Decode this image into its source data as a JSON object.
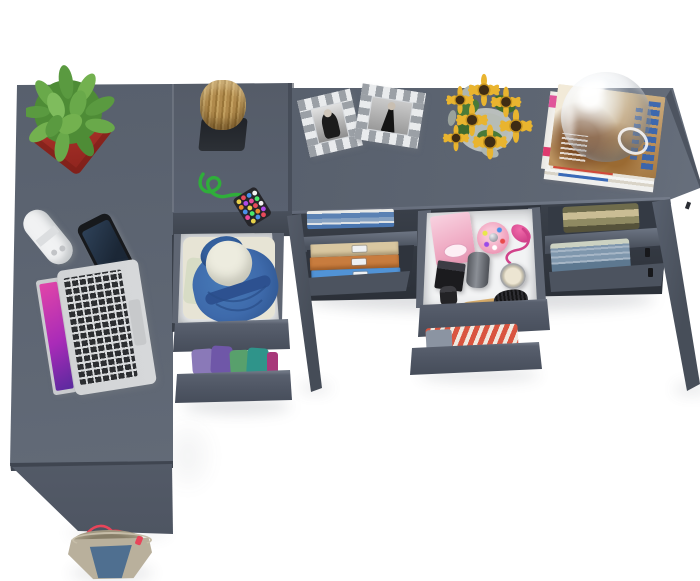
{
  "image_type": "product-photography",
  "subject": "Top-down view of a graphite grey L-shaped corner desk with open drawers and shelves styled with household props",
  "visible_text": [],
  "furniture": {
    "left_wing": "desk top with front panel leg",
    "corner_unit": "square top with two pulled-out drawers",
    "right_wing": "desk top with one open shelf bay, one pulled-out drawer, one shelf bay, two tapered legs"
  },
  "inventory": [
    "cactus in red pot",
    "white charger",
    "smartphone",
    "open laptop",
    "wood stump",
    "black desk pad",
    "green cord keychain with beaded tag",
    "drawer with blue backpack and white shirt",
    "drawer with folded purple, green and teal clothes",
    "shelf with folded blue clothes",
    "stack of beige, orange and blue storage boxes",
    "cosmetics drawer with pink gift box, candy perfume, pink atomizer, black bottles, cream jar and wooden hairbrush",
    "drawer with red striped clothes",
    "shelf with khaki clothes",
    "shelf with folded jeans",
    "two silver checkered picture frames with black and white photos",
    "sunflower bouquet in glass vase",
    "magazine stack",
    "glass dome ball",
    "denim tote bag with red handles"
  ],
  "palette": {
    "bg": "#ffffff",
    "desk_top": "#5a626f",
    "panel": "#535a67",
    "drawer_front": "#4f5664",
    "drawer_bevel": "#6e7683",
    "drawer_wall": "#5f6673",
    "drawer_interior": "#f2f3f4",
    "box_beige": "#d9c7a0",
    "box_orange": "#c87c3e",
    "box_blue": "#5193d6",
    "backpack_blue": "#3e6aab",
    "pot_red": "#b5362c",
    "cactus_green": "#5a9a40",
    "sunflower_petal": "#e6b42e",
    "sunflower_center": "#3f2c14",
    "magazine_blue": "#2f62b5",
    "pink_box": "#f2b8cc",
    "pink_accent": "#e0559a",
    "stripe_red": "#d95540",
    "denim": "#7f97ad",
    "bag_denim": "#4f6f90",
    "bag_beige": "#b9b09c",
    "handle_red": "#e8455a",
    "wood": "#b08a4c",
    "cord_green": "#2fae3a",
    "laptop_silver": "#d6d8da",
    "screen_pink": "#d94fae",
    "purple": "#6f57a8",
    "teal": "#2f948a",
    "green": "#58a06c",
    "khaki": "#8f8a62"
  }
}
